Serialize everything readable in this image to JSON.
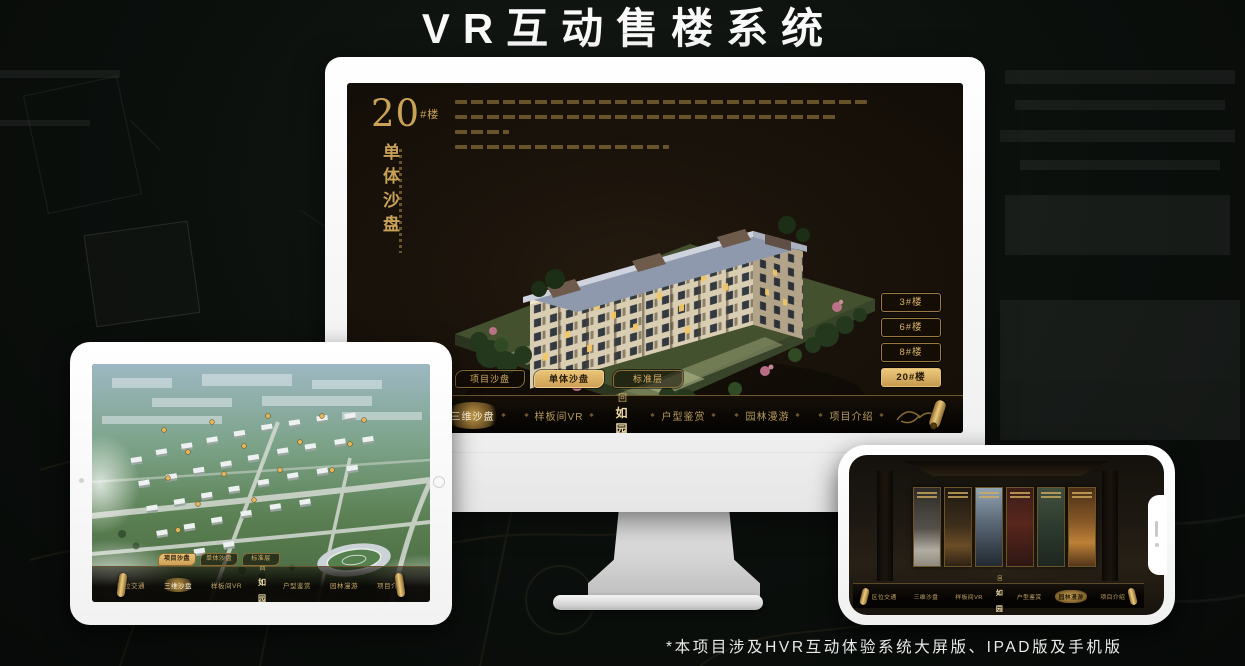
{
  "page": {
    "title": "VR互动售楼系统",
    "footnote": "*本项目涉及HVR互动体验系统大屏版、IPAD版及手机版"
  },
  "colors": {
    "gold": "#c9a257",
    "gold_bright": "#ecca7e",
    "screen_background": "#1a130b",
    "nav_background": "#0a0704",
    "title_text": "#fafafa"
  },
  "app": {
    "logo": "如园",
    "logo_mark": "回",
    "nav_items": [
      {
        "label": "区位交通"
      },
      {
        "label": "三维沙盘"
      },
      {
        "label": "样板间VR"
      },
      {
        "label": "户型鉴赏"
      },
      {
        "label": "园林漫游"
      },
      {
        "label": "项目介绍"
      }
    ]
  },
  "monitor": {
    "heading": {
      "number": "20",
      "suffix": "#楼",
      "subtitle": "单体沙盘"
    },
    "tabs": [
      {
        "label": "项目沙盘",
        "active": false
      },
      {
        "label": "单体沙盘",
        "active": true
      },
      {
        "label": "标准层",
        "active": false
      }
    ],
    "floor_buttons": [
      {
        "label": "3#楼",
        "active": false
      },
      {
        "label": "6#楼",
        "active": false
      },
      {
        "label": "8#楼",
        "active": false
      },
      {
        "label": "20#楼",
        "active": true
      }
    ],
    "active_nav": "三维沙盘"
  },
  "tablet": {
    "view": "项目沙盘鸟瞰",
    "tabs": [
      {
        "label": "项目沙盘",
        "active": true
      },
      {
        "label": "单体沙盘",
        "active": false
      },
      {
        "label": "标准层",
        "active": false
      }
    ],
    "active_nav": "三维沙盘"
  },
  "phone": {
    "view": "实景展廊",
    "active_nav": "园林漫游",
    "panel_count": 6
  }
}
